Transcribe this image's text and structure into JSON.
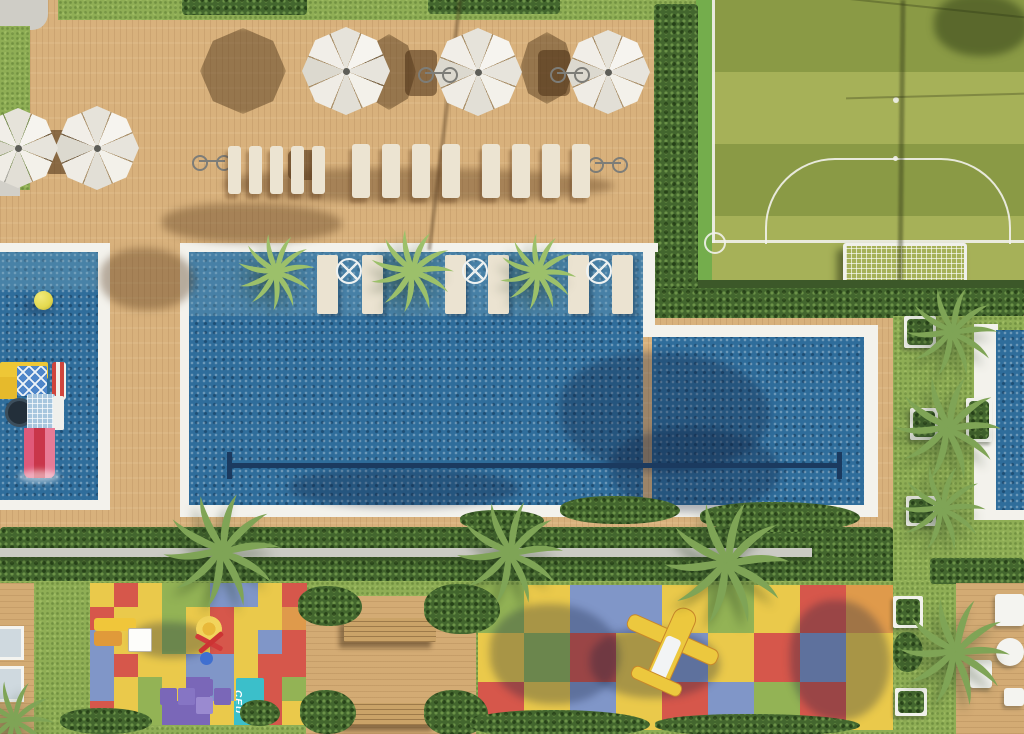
{
  "labels": {
    "ceu_mat": "CEU"
  },
  "palette": {
    "deck_wood": "#d8b17c",
    "grass": "#8fae55",
    "field_stripe_dark": "#8a9a45",
    "field_stripe_light": "#a6b158",
    "hedge_green": "#43662e",
    "pool_water": "#2f6d9b",
    "pool_border_white": "#f3f2ec",
    "lane_line_navy": "#1b3a5f",
    "umbrella_white": "#f1efe8",
    "lounger_cream": "#ece4d2",
    "bench_gray": "#cbcbc4",
    "ball_yellow": "#e3d94f",
    "playset_yellow": "#eec736",
    "playset_blue": "#4f86c9",
    "playset_slide_pink": "#e8638c",
    "airplane_yellow": "#ecc83e",
    "ceu_mat_teal": "#3bbfca",
    "hopscotch_purple": "#7a67b8"
  },
  "mats": {
    "colors": {
      "R": "#d6574b",
      "Y": "#eac94b",
      "G": "#93b355",
      "B": "#8096c8",
      "O": "#df9a4b",
      "P": "#7a67b8",
      "T": "#3bbfca"
    },
    "left": {
      "rows": 6,
      "cols": 9,
      "grid": [
        [
          "Y",
          "R",
          "Y",
          "G",
          "G",
          "B",
          "B",
          "Y",
          "R"
        ],
        [
          "R",
          "Y",
          "Y",
          "G",
          "Y",
          "R",
          "Y",
          "Y",
          "O"
        ],
        [
          "B",
          "Y",
          "Y",
          "G",
          "Y",
          "R",
          "Y",
          "B",
          "R"
        ],
        [
          "B",
          "R",
          "Y",
          "Y",
          "B",
          "B",
          "Y",
          "R",
          "R"
        ],
        [
          "B",
          "Y",
          "G",
          "Y",
          "P",
          "B",
          "Y",
          "R",
          "G"
        ],
        [
          "R",
          "Y",
          "G",
          "P",
          "P",
          "Y",
          "T",
          "R",
          "Y"
        ]
      ]
    },
    "right": {
      "rows": 3,
      "cols": 9,
      "grid": [
        [
          "G",
          "Y",
          "B",
          "B",
          "Y",
          "G",
          "Y",
          "R",
          "O"
        ],
        [
          "Y",
          "G",
          "R",
          "Y",
          "B",
          "Y",
          "R",
          "B",
          "Y"
        ],
        [
          "R",
          "Y",
          "B",
          "Y",
          "R",
          "B",
          "G",
          "R",
          "Y"
        ]
      ]
    }
  },
  "scene_objects": {
    "pools": [
      "kids-pool",
      "main-lap-pool",
      "side-pool"
    ],
    "sports": [
      "soccer-field"
    ],
    "play_areas": [
      "left-playground-mat",
      "right-playground-mat",
      "hopscotch",
      "airplane-toy",
      "pool-playset"
    ],
    "furniture": [
      "umbrellas",
      "sun-loungers",
      "in-pool-loungers",
      "wood-benches",
      "deck-furniture"
    ]
  }
}
